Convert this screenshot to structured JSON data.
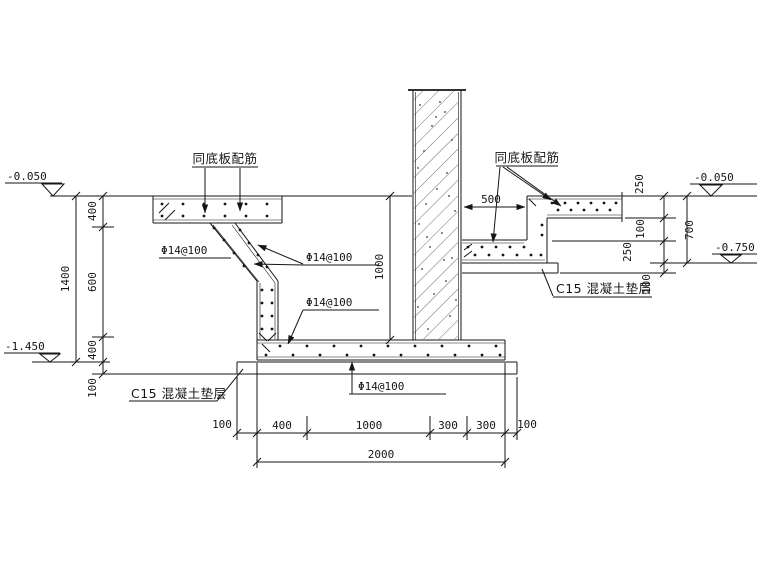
{
  "notes": {
    "rebar_note": "同底板配筋",
    "rebar_spec": "Φ14@100",
    "cushion_note": "C15 混凝土垫层"
  },
  "elevations": {
    "left_top": "-0.050",
    "left_bottom": "-1.450",
    "right_top": "-0.050",
    "right_bottom": "-0.750"
  },
  "dims": {
    "left": {
      "total": "1400",
      "segments": [
        "400",
        "600",
        "400"
      ],
      "cushion": "100"
    },
    "middle": {
      "wall_height": "1000",
      "step_offset": "500"
    },
    "right": {
      "segments": [
        "250",
        "100",
        "250",
        "100"
      ],
      "total": "700"
    },
    "bottom": {
      "overhang_left": "100",
      "segments": [
        "400",
        "1000",
        "300",
        "300"
      ],
      "overhang_right": "100",
      "total": "2000"
    }
  }
}
